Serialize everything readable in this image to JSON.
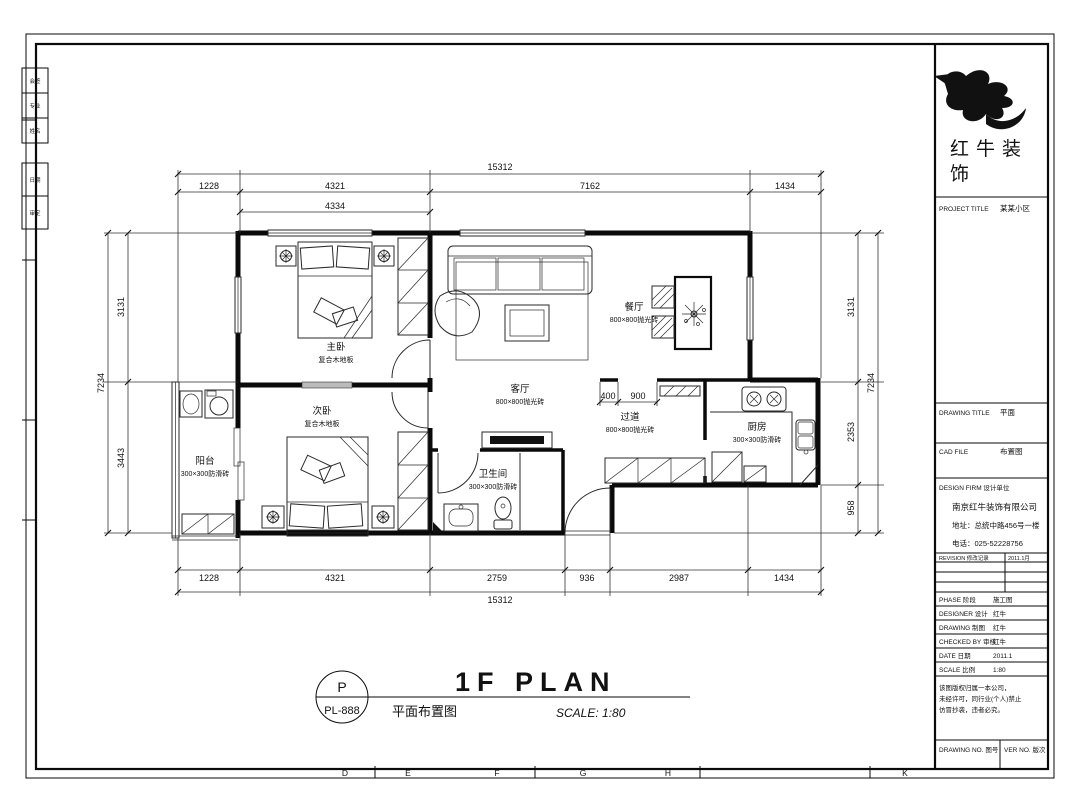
{
  "sheet": {
    "edge_letters": [
      "D",
      "E",
      "F",
      "G",
      "H",
      "K"
    ],
    "side_cells": [
      "会签",
      "专业",
      "姓名",
      "日期",
      "审定"
    ]
  },
  "plan": {
    "rooms": {
      "master": {
        "name": "主卧",
        "finish": "复合木地板"
      },
      "second": {
        "name": "次卧",
        "finish": "复合木地板"
      },
      "living": {
        "name": "客厅",
        "finish": "800×800抛光砖"
      },
      "dining": {
        "name": "餐厅",
        "finish": "800×800抛光砖"
      },
      "hall": {
        "name": "过道",
        "finish": "800×800抛光砖"
      },
      "kitchen": {
        "name": "厨房",
        "finish": "300×300防滑砖"
      },
      "bath": {
        "name": "卫生间",
        "finish": "300×300防滑砖"
      },
      "balcony": {
        "name": "阳台",
        "finish": "300×300防滑砖"
      }
    },
    "dims": {
      "top": {
        "total": "15312",
        "segments": [
          "1228",
          "4321",
          "7162",
          "1434"
        ],
        "sub": "4334"
      },
      "bottom": {
        "total": "15312",
        "segments": [
          "1228",
          "4321",
          "2759",
          "936",
          "2987",
          "1434"
        ]
      },
      "left": {
        "total": "7234",
        "segments": [
          "3131",
          "3443"
        ]
      },
      "right": {
        "total": "7234",
        "segments": [
          "3131",
          "2353",
          "958"
        ]
      },
      "interior": [
        "400",
        "900"
      ]
    }
  },
  "title_bar": {
    "marker_letter": "P",
    "marker_number": "PL-888",
    "title": "1F PLAN",
    "subtitle": "平面布置图",
    "scale": "SCALE: 1:80"
  },
  "title_block": {
    "logo_line1": "红牛装",
    "logo_line2": "饰",
    "project_title_label": "PROJECT TITLE",
    "project_title_value": "某某小区",
    "drawing_title_label": "DRAWING TITLE",
    "drawing_title_value": "平面",
    "file_label": "CAD FILE",
    "file_value": "布置图",
    "firm_label": "DESIGN FIRM 设计单位",
    "firm_name": "南京红牛装饰有限公司",
    "firm_address": "地址：总统中路456号一楼",
    "firm_phone": "电话：025-52228756",
    "rev_header_left": "REVISION 修改记录",
    "rev_header_right": "2011.1月",
    "rows": [
      {
        "label": "PHASE 阶段",
        "value": "施工图"
      },
      {
        "label": "DESIGNER 设计",
        "value": "红牛"
      },
      {
        "label": "DRAWING 制图",
        "value": "红牛"
      },
      {
        "label": "CHECKED BY 审核",
        "value": "红牛"
      },
      {
        "label": "DATE 日期",
        "value": "2011.1"
      },
      {
        "label": "SCALE 比例",
        "value": "1:80"
      }
    ],
    "note_lines": [
      "该图版权归属一本公司，",
      "未经许可，同行业(个人)禁止",
      "仿冒抄袭，违者必究。"
    ],
    "drawing_no_label": "DRAWING NO. 图号",
    "version_label": "VER NO. 版次"
  }
}
